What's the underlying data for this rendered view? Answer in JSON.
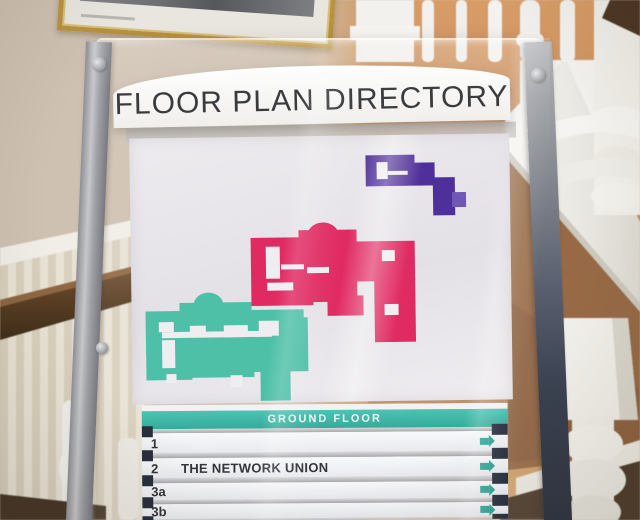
{
  "sign": {
    "title": "FLOOR PLAN DIRECTORY",
    "banner": {
      "label": "GROUND FLOOR"
    },
    "rows": [
      {
        "number": "1",
        "name": ""
      },
      {
        "number": "2",
        "name": "THE NETWORK UNION"
      },
      {
        "number": "3a",
        "name": ""
      },
      {
        "number": "3b",
        "name": ""
      }
    ],
    "colors": {
      "banner_teal": "#3cb5a5",
      "arrow_teal": "#2ba193",
      "building_teal": "#4fc0a8",
      "building_pink": "#e02a62",
      "building_purple": "#4f2f99",
      "building_purple_light": "#7157b4",
      "divider_cap_dark": "#272e3c"
    }
  }
}
